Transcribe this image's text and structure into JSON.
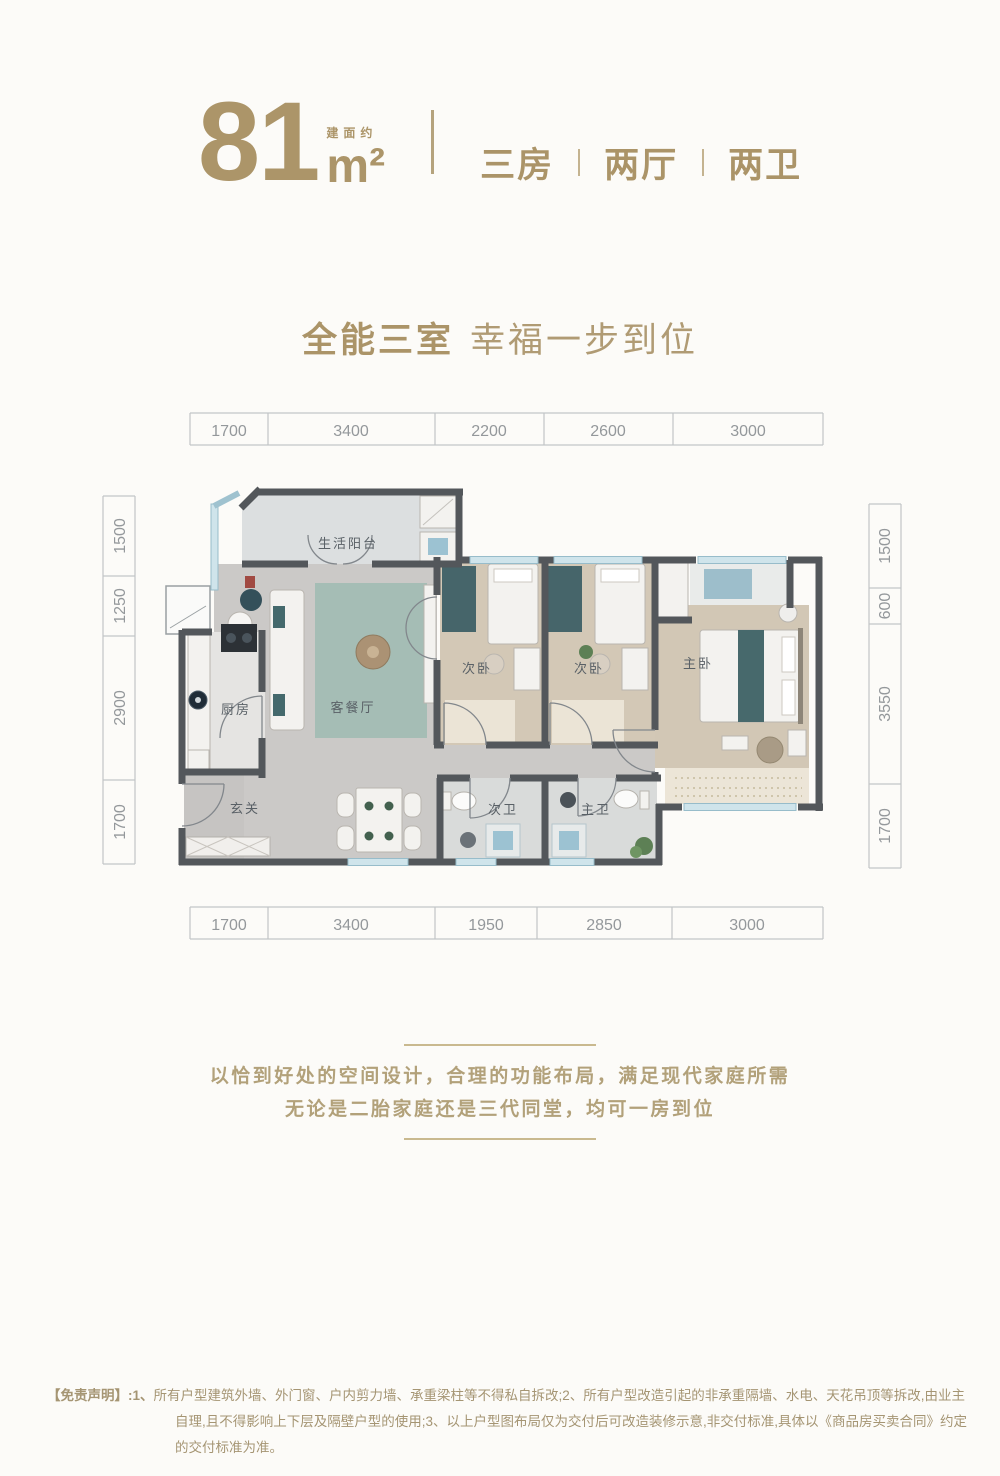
{
  "header": {
    "area_value": "81",
    "area_prefix": "建面约",
    "area_unit": "m²",
    "specs": [
      "三房",
      "两厅",
      "两卫"
    ]
  },
  "title": {
    "part1": "全能三室",
    "part2": "幸福一步到位"
  },
  "plan": {
    "dims_top": [
      "1700",
      "3400",
      "2200",
      "2600",
      "3000"
    ],
    "dims_bottom": [
      "1700",
      "3400",
      "1950",
      "2850",
      "3000"
    ],
    "dims_left": [
      "1500",
      "1250",
      "2900",
      "1700"
    ],
    "dims_right": [
      "1500",
      "600",
      "3550",
      "1700"
    ],
    "rooms": {
      "balcony": "生活阳台",
      "kitchen": "厨房",
      "living": "客餐厅",
      "entry": "玄关",
      "bedroom2a": "次卧",
      "bedroom2b": "次卧",
      "master": "主卧",
      "bath2": "次卫",
      "bath_master": "主卫"
    }
  },
  "description": {
    "line1": "以恰到好处的空间设计，合理的功能布局，满足现代家庭所需",
    "line2": "无论是二胎家庭还是三代同堂，均可一房到位"
  },
  "disclaimer": {
    "label": "【免责声明】:1、",
    "lines": [
      "所有户型建筑外墙、外门窗、户内剪力墙、承重梁柱等不得私自拆改;2、所有户型改造引起的非承重隔墙、水电、天花吊顶等拆改,由业主",
      "自理,且不得影响上下层及隔壁户型的使用;3、以上户型图布局仅为交付后可改造装修示意,非交付标准,具体以《商品房买卖合同》约定",
      "的交付标准为准。"
    ]
  },
  "colors": {
    "gold": "#ab9468",
    "wall": "#53575b",
    "window_blue": "#cfe4eb",
    "wood_floor": "#d2c7b5",
    "marble_floor": "#cac8c6",
    "rug_teal": "#a5bdb5",
    "accent_teal": "#44696c",
    "dim_gray": "#94989b"
  }
}
